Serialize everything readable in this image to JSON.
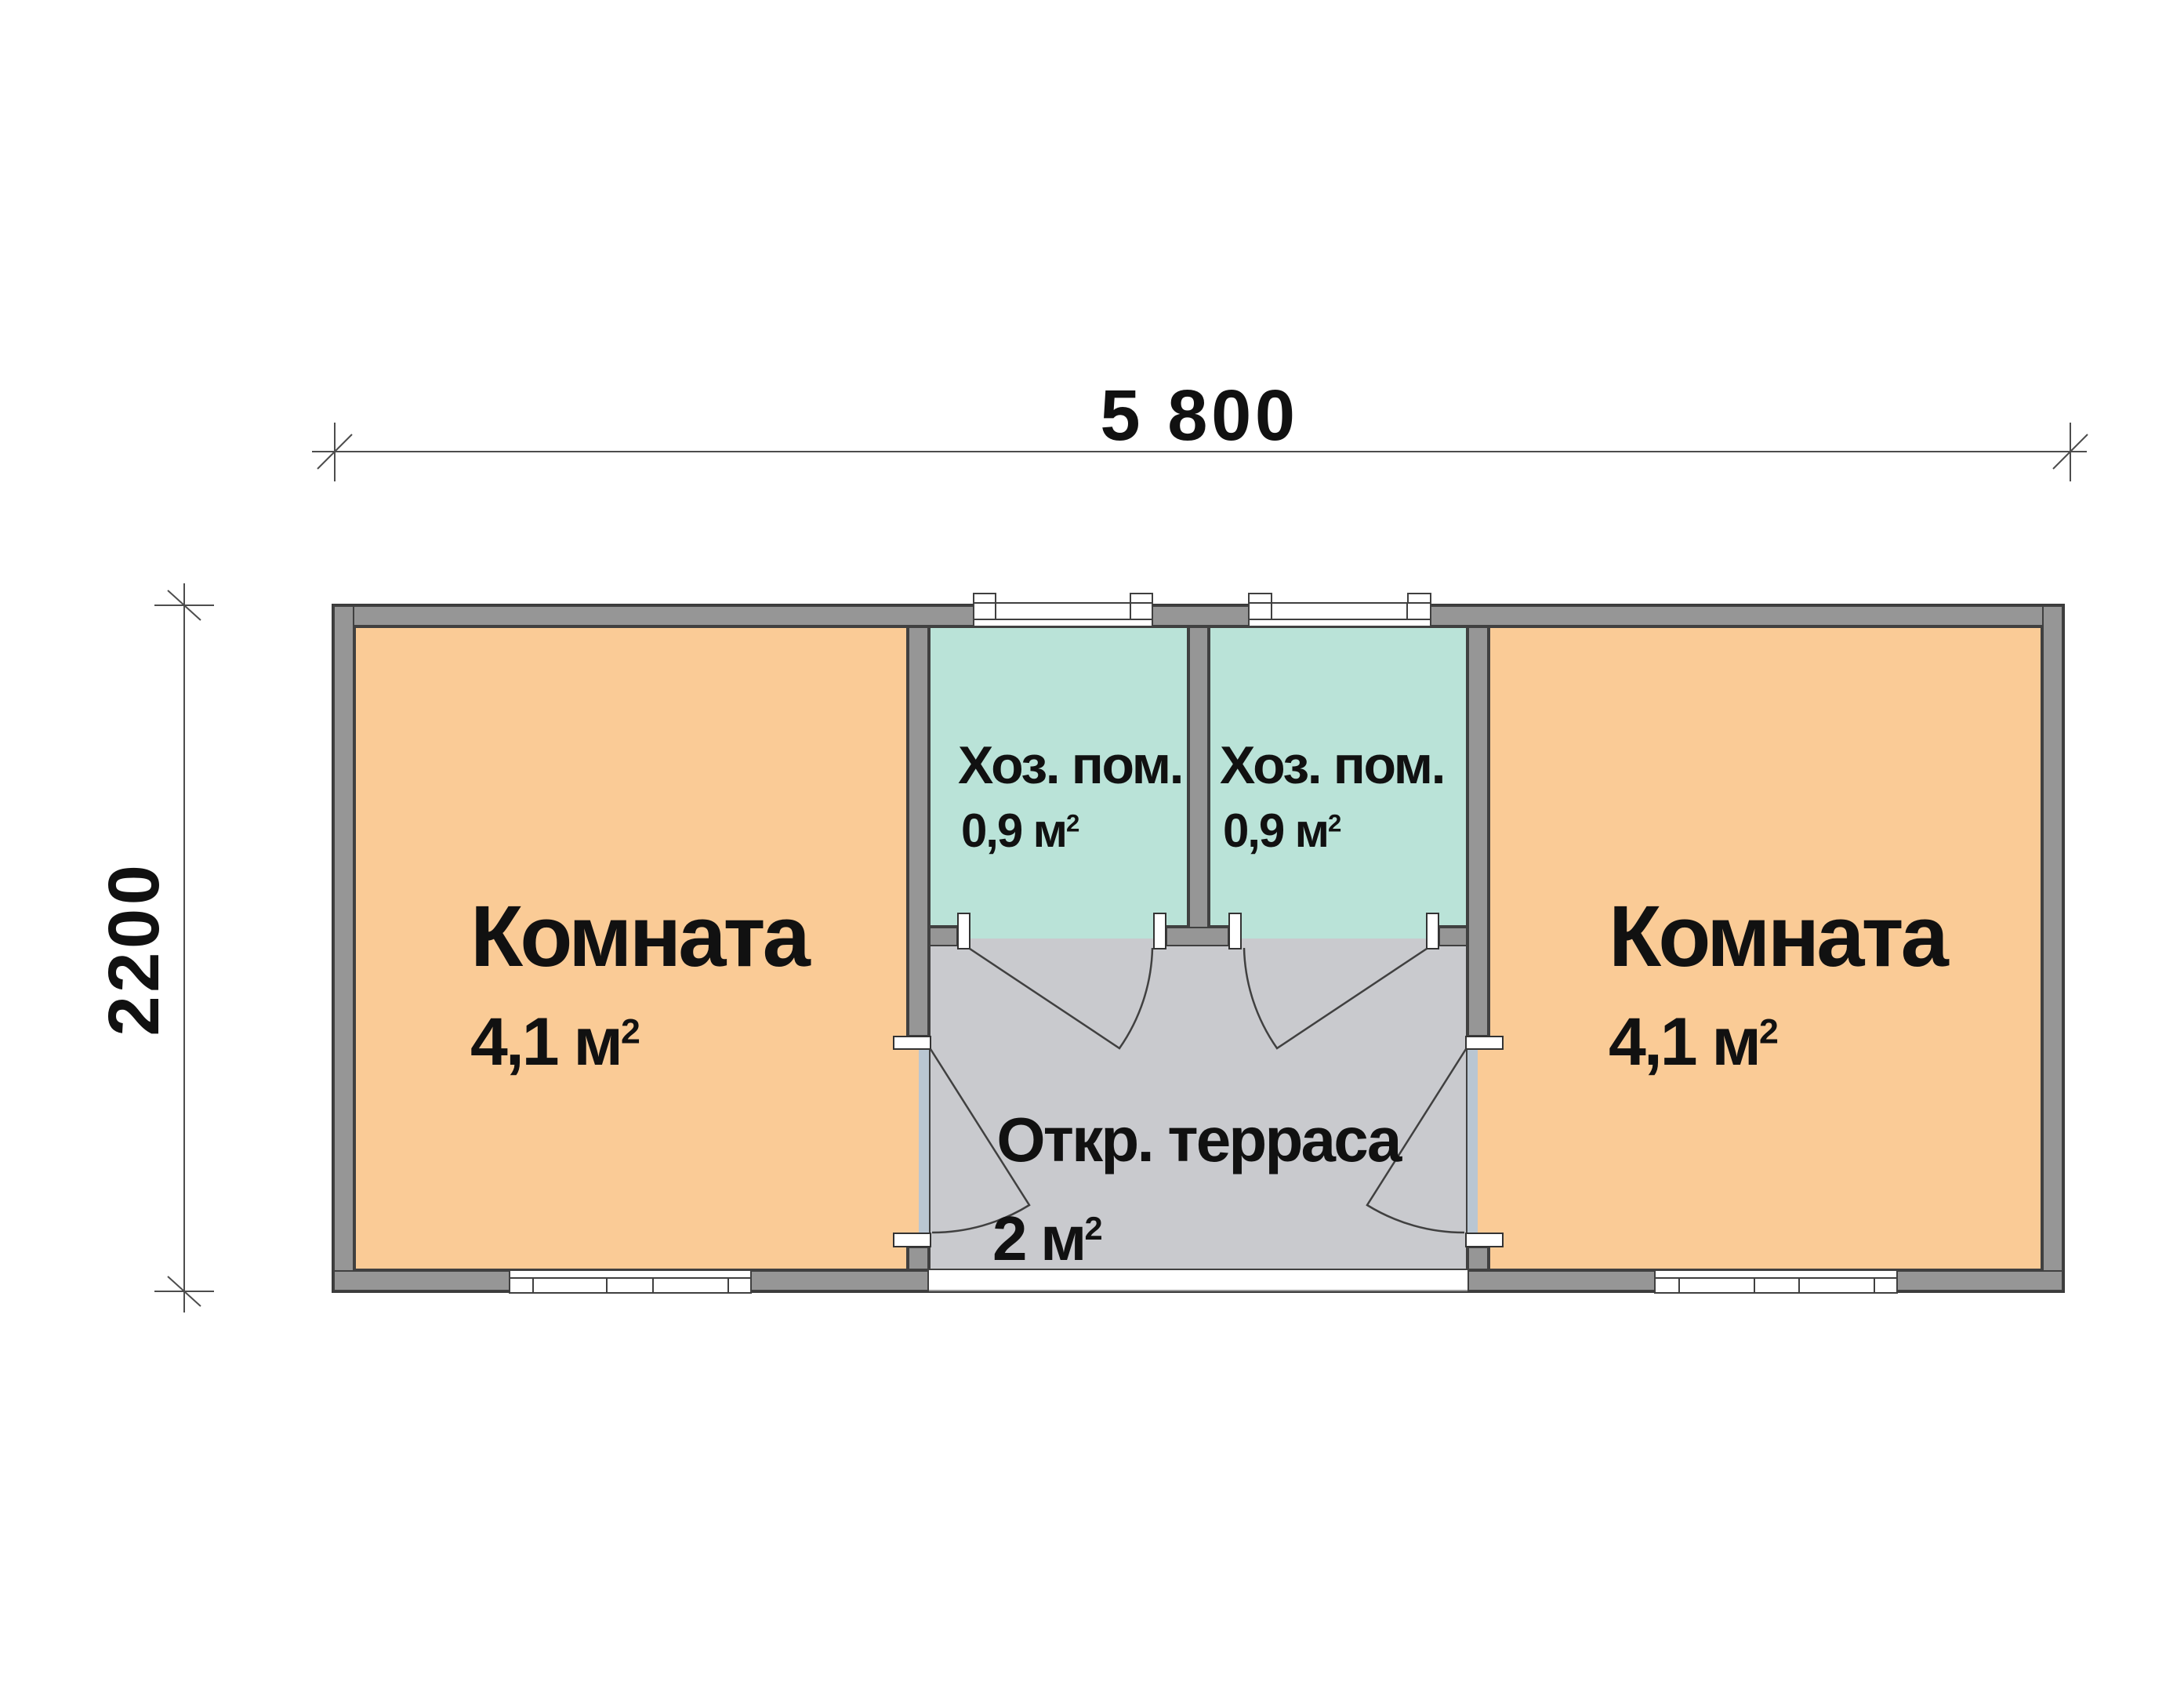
{
  "dimensions": {
    "width_label": "5 800",
    "height_label": "2200"
  },
  "rooms": {
    "room_left": {
      "name": "Комната",
      "area": "4,1 м",
      "area_sup": "2"
    },
    "room_right": {
      "name": "Комната",
      "area": "4,1 м",
      "area_sup": "2"
    },
    "utility_left": {
      "name": "Хоз. пом.",
      "area": "0,9 м",
      "area_sup": "2"
    },
    "utility_right": {
      "name": "Хоз. пом.",
      "area": "0,9 м",
      "area_sup": "2"
    },
    "terrace": {
      "name": "Откр. терраса",
      "area": "2 м",
      "area_sup": "2"
    }
  },
  "colors": {
    "room_fill": "#FACB96",
    "utility_fill": "#BAE3D8",
    "terrace_fill": "#C9CACE",
    "wall": "#969696",
    "threshold": "#B9C6D2",
    "line": "#404040",
    "dimension_line": "#4d4d4d",
    "text": "#111111"
  }
}
